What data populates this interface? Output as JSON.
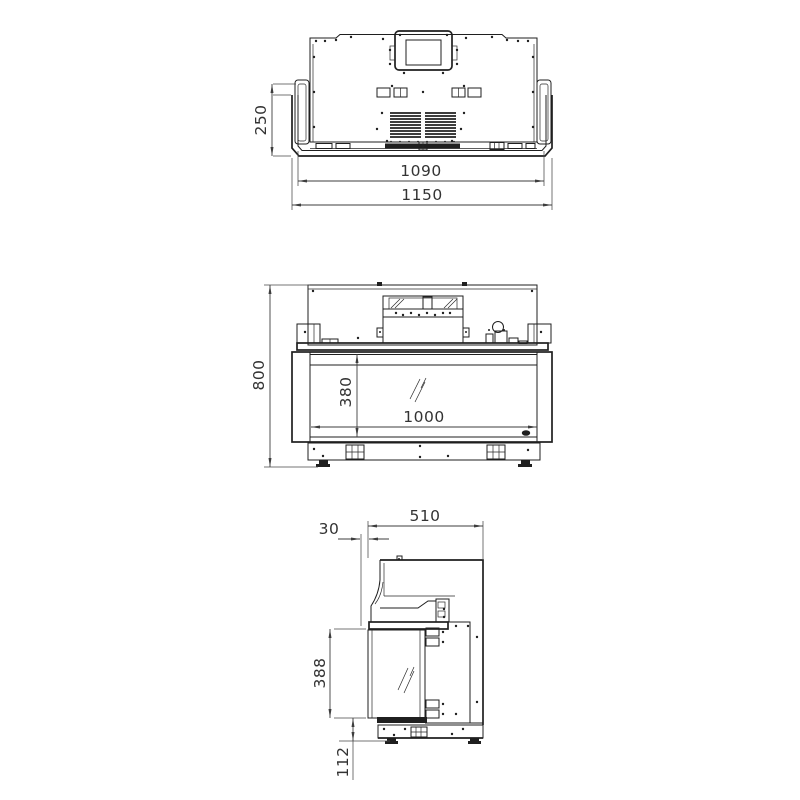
{
  "drawing_type": "fireplace-insert-technical-drawing",
  "style": {
    "line_color": "#1f1f1f",
    "dimension_color": "#3d3d3d",
    "background": "#ffffff"
  },
  "views": {
    "top": {
      "dims": {
        "recess_depth": "250",
        "inner_width": "1090",
        "overall_width": "1150"
      }
    },
    "front": {
      "dims": {
        "overall_height": "800",
        "glass_height": "380",
        "glass_width": "1000"
      }
    },
    "side": {
      "dims": {
        "overall_depth": "510",
        "front_offset": "30",
        "glass_height": "388",
        "plinth_height": "112"
      }
    }
  }
}
